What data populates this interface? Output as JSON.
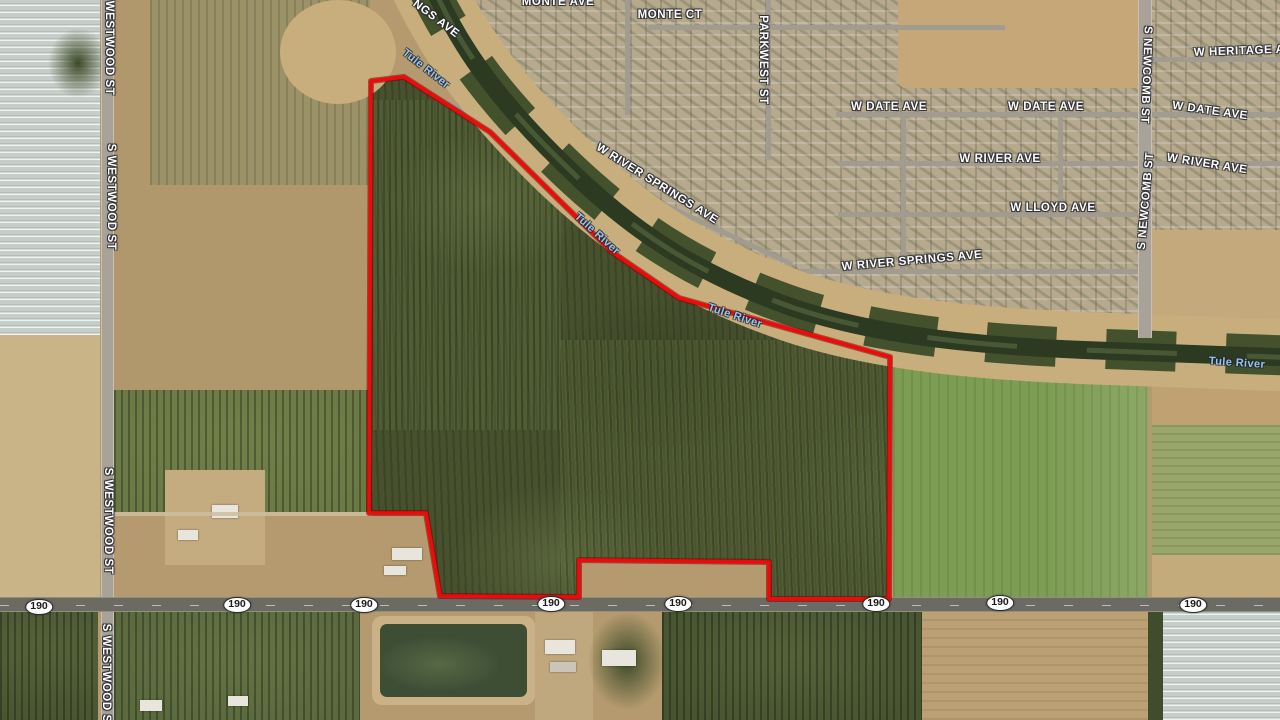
{
  "map": {
    "description": "satellite-parcel-map",
    "route_shield_label": "190",
    "parcel_boundary_color": "#ee0a0a",
    "parcel_boundary_points": "371,81 404,77 490,132 560,201 612,252 679,298 890,357 889,599 769,599 769,562 579,560 579,597 440,596 426,513 369,513",
    "water_label_color": "#9dc4e6"
  },
  "street_labels": [
    {
      "text": "MONTE AVE",
      "x": 558,
      "y": 2,
      "rot": 0
    },
    {
      "text": "MONTE CT",
      "x": 670,
      "y": 15,
      "rot": 0
    },
    {
      "text": "W HERITAGE AVE",
      "x": 1247,
      "y": 51,
      "rot": -2
    },
    {
      "text": "W DATE AVE",
      "x": 889,
      "y": 107,
      "rot": 0
    },
    {
      "text": "W DATE AVE",
      "x": 1046,
      "y": 107,
      "rot": 0
    },
    {
      "text": "W DATE AVE",
      "x": 1210,
      "y": 111,
      "rot": 8
    },
    {
      "text": "W RIVER AVE",
      "x": 1000,
      "y": 159,
      "rot": 0
    },
    {
      "text": "W RIVER AVE",
      "x": 1207,
      "y": 164,
      "rot": 9
    },
    {
      "text": "W LLOYD AVE",
      "x": 1053,
      "y": 208,
      "rot": 0
    },
    {
      "text": "W RIVER SPRINGS AVE",
      "x": 912,
      "y": 261,
      "rot": -5
    },
    {
      "text": "W RIVER SPRINGS AVE",
      "x": 657,
      "y": 184,
      "rot": 32
    },
    {
      "text": "NGS AVE",
      "x": 436,
      "y": 19,
      "rot": 37
    },
    {
      "text": "S WESTWOOD ST",
      "x": 109,
      "y": 42,
      "rot": 90
    },
    {
      "text": "S WESTWOOD ST",
      "x": 111,
      "y": 197,
      "rot": 90
    },
    {
      "text": "S WESTWOOD ST",
      "x": 108,
      "y": 521,
      "rot": 90
    },
    {
      "text": "S WESTWOOD ST",
      "x": 106,
      "y": 677,
      "rot": 90
    },
    {
      "text": "PARKWEST ST",
      "x": 763,
      "y": 60,
      "rot": 90
    },
    {
      "text": "S NEWCOMB ST",
      "x": 1146,
      "y": 75,
      "rot": 92
    },
    {
      "text": "S NEWCOMB ST",
      "x": 1146,
      "y": 201,
      "rot": -85
    }
  ],
  "water_labels": [
    {
      "text": "Tule River",
      "x": 426,
      "y": 69,
      "rot": 38
    },
    {
      "text": "Tule River",
      "x": 597,
      "y": 234,
      "rot": 42
    },
    {
      "text": "Tule River",
      "x": 735,
      "y": 316,
      "rot": 18
    },
    {
      "text": "Tule River",
      "x": 1237,
      "y": 363,
      "rot": 4
    }
  ],
  "route_shields": [
    {
      "x": 39,
      "y": 607
    },
    {
      "x": 237,
      "y": 605
    },
    {
      "x": 364,
      "y": 605
    },
    {
      "x": 551,
      "y": 604
    },
    {
      "x": 678,
      "y": 604
    },
    {
      "x": 876,
      "y": 604
    },
    {
      "x": 1000,
      "y": 603
    },
    {
      "x": 1193,
      "y": 605
    }
  ]
}
